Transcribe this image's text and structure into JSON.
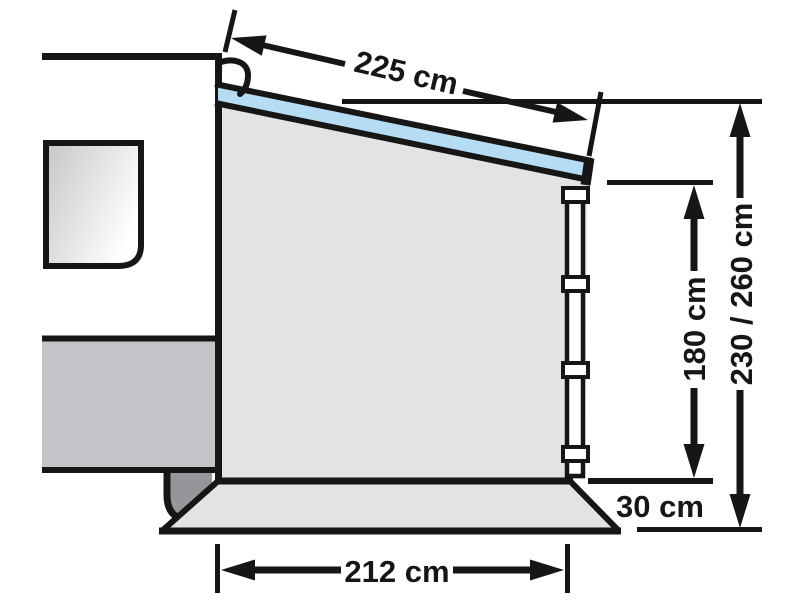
{
  "diagram": {
    "subject": "caravan-side-awning-panel-dimension-drawing",
    "labels": {
      "roof_depth": "225 cm",
      "rear_height": "180 cm",
      "overall_height": "230 / 260 cm",
      "ground_clearance": "30 cm",
      "base_width": "212 cm"
    },
    "colors": {
      "outline": "#161616",
      "awning_roof": "#b5dcf2",
      "panel": "#e3e3e6",
      "caravan_skirt": "#c4c4c8",
      "wheel": "#96969a",
      "background": "#ffffff"
    }
  }
}
